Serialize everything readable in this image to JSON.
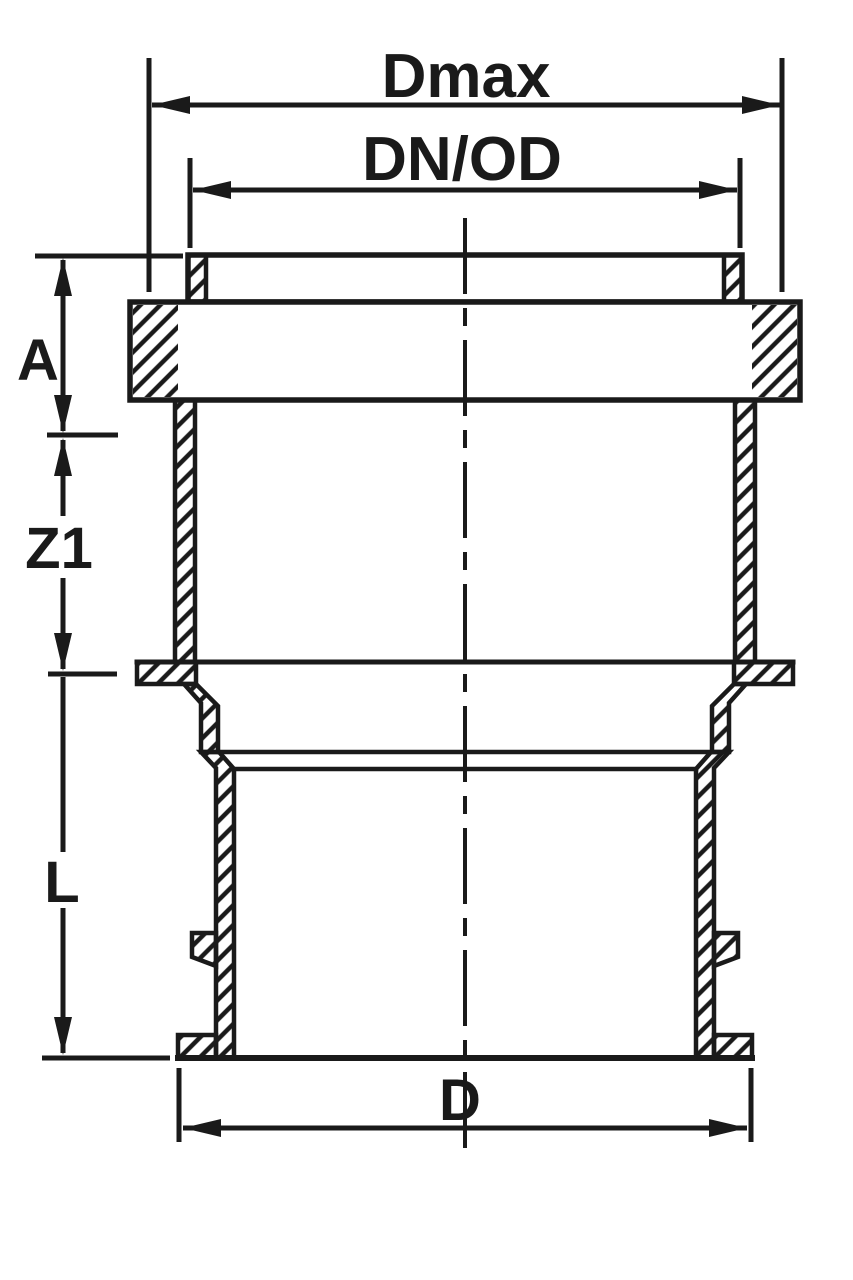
{
  "page": {
    "background": "#ffffff"
  },
  "drawing": {
    "kind": "pipe-fitting-sectional-drawing",
    "line_color": "#1a1a1a",
    "hatch_color": "#1a1a1a",
    "labels": {
      "dmax": "Dmax",
      "dn_od": "DN/OD",
      "a": "A",
      "z1": "Z1",
      "l": "L",
      "d": "D"
    }
  }
}
